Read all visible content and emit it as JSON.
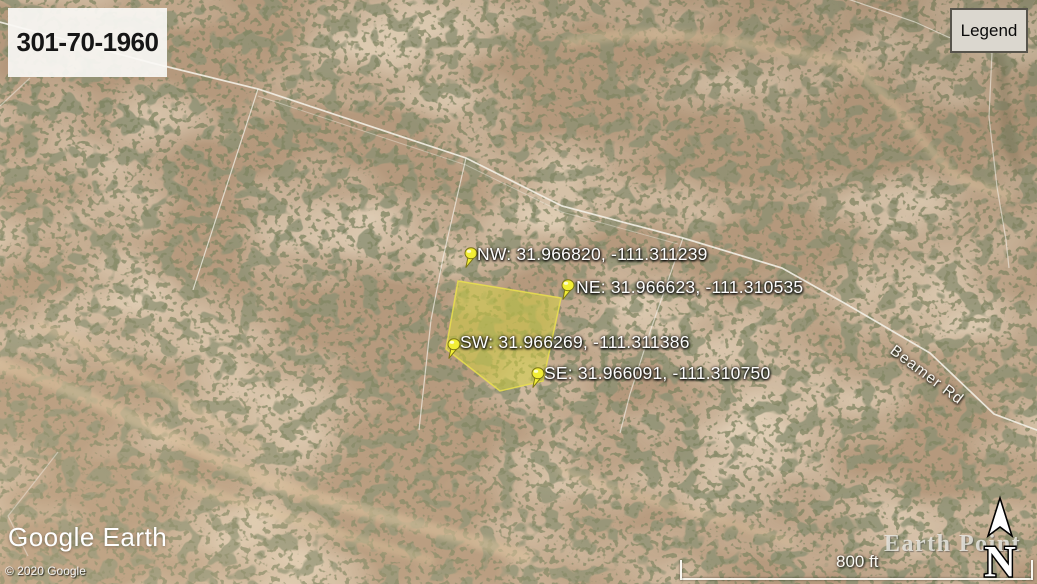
{
  "header": {
    "parcel_id": "301-70-1960",
    "legend_label": "Legend"
  },
  "map": {
    "parcel_color": "#d6d33e",
    "pin_color": "#f2ee35",
    "road_label": "Beamer Rd",
    "pins": [
      {
        "corner": "NW",
        "lat": "31.966820",
        "lon": "-111.311239",
        "label": "NW: 31.966820, -111.311239"
      },
      {
        "corner": "NE",
        "lat": "31.966623",
        "lon": "-111.310535",
        "label": "NE: 31.966623, -111.310535"
      },
      {
        "corner": "SW",
        "lat": "31.966269",
        "lon": "-111.311386",
        "label": "SW: 31.966269, -111.311386"
      },
      {
        "corner": "SE",
        "lat": "31.966091",
        "lon": "-111.310750",
        "label": "SE: 31.966091, -111.310750"
      }
    ]
  },
  "footer": {
    "logo": "Google Earth",
    "copyright": "© 2020 Google",
    "watermark": "Earth Point",
    "compass_label": "N",
    "scale_label": "800 ft"
  }
}
